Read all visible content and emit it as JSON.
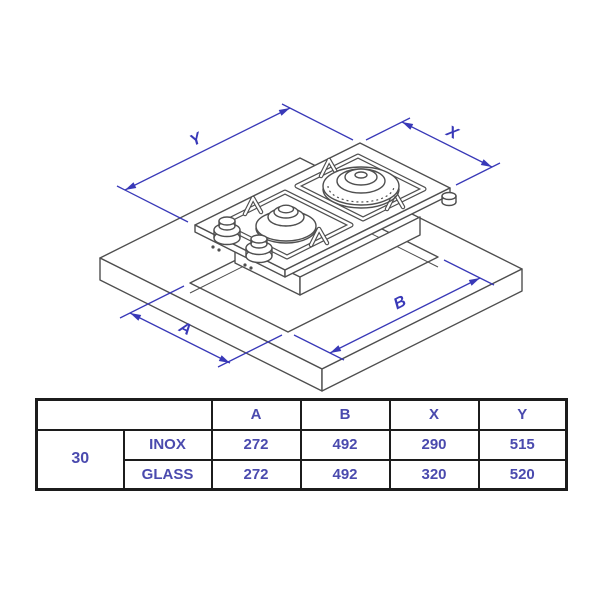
{
  "diagram": {
    "dim_labels": {
      "y": "Y",
      "x": "X",
      "a": "A",
      "b": "B"
    },
    "colors": {
      "dimension_blue": "#3939b8",
      "drawing_line_gray": "#4f4f4f",
      "table_text_blue": "#4a4aae",
      "table_border_black": "#1c1c1c"
    }
  },
  "table": {
    "header_cols": [
      "A",
      "B",
      "X",
      "Y"
    ],
    "size_label": "30",
    "rows": [
      {
        "variant": "INOX",
        "a": "272",
        "b": "492",
        "x": "290",
        "y": "515"
      },
      {
        "variant": "GLASS",
        "a": "272",
        "b": "492",
        "x": "320",
        "y": "520"
      }
    ]
  }
}
